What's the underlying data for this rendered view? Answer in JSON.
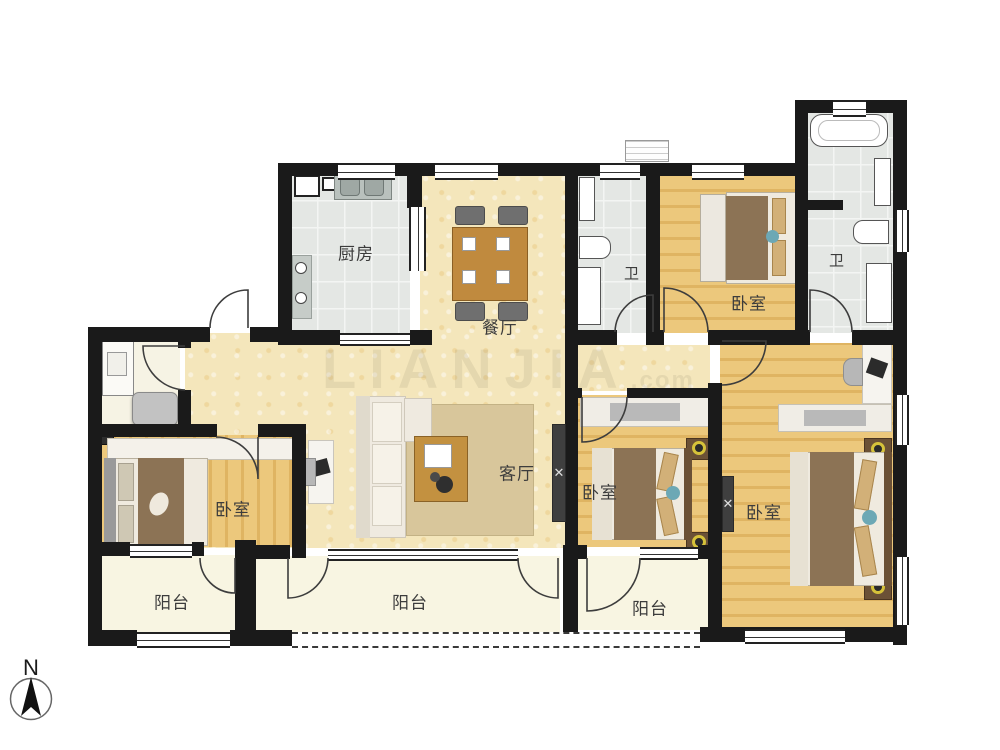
{
  "watermark": {
    "text": "LIANJIA",
    "suffix": ".com"
  },
  "compass": {
    "north_label": "N"
  },
  "rooms": {
    "kitchen": {
      "label": "厨房"
    },
    "dining": {
      "label": "餐厅"
    },
    "bathroom_top": {
      "label": "卫"
    },
    "bedroom_top_right": {
      "label": "卧室"
    },
    "bathroom_right": {
      "label": "卫"
    },
    "bedroom_left": {
      "label": "卧室"
    },
    "living": {
      "label": "客厅"
    },
    "bedroom_bottom_center": {
      "label": "卧室"
    },
    "bedroom_bottom_right": {
      "label": "卧室"
    },
    "balcony_left": {
      "label": "阳台"
    },
    "balcony_center": {
      "label": "阳台"
    },
    "balcony_right": {
      "label": "阳台"
    }
  },
  "colors": {
    "wall": "#1a1a1a",
    "wood_floor": "#e9c173",
    "living_floor": "#f4e6bb",
    "tile_floor": "#e4e7e4",
    "balcony_floor": "#f8f5e2",
    "blanket": "#8c7355",
    "accent_teal": "#6ca8b5"
  }
}
